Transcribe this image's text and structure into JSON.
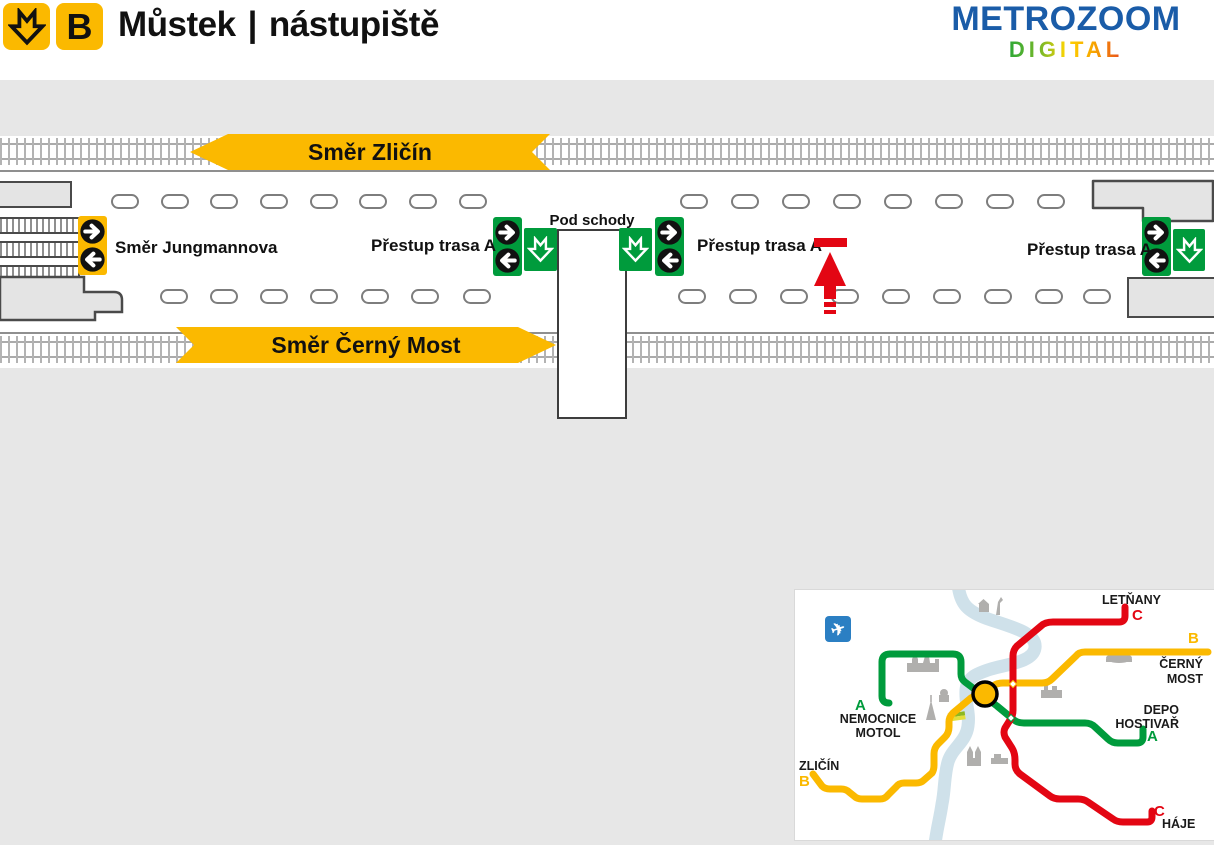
{
  "header": {
    "metro_line_letter": "B",
    "station_name": "Můstek",
    "separator": "|",
    "area_name": "nástupiště",
    "brand_name": "METROZOOM",
    "brand_sub": "DIGITAL",
    "brand_color": "#1A5CA8",
    "accent_yellow": "#FBB900"
  },
  "platform": {
    "direction_banner_top": "Směr Zličín",
    "direction_banner_bottom": "Směr Černý Most",
    "label_jungmannova": "Směr Jungmannova",
    "label_transfer_left": "Přestup trasa A",
    "label_under_stairs": "Pod schody",
    "label_transfer_middle": "Přestup trasa A",
    "label_transfer_right": "Přestup trasa A",
    "bench_rows": {
      "top_y": 194,
      "bottom_y": 289,
      "top_x": [
        111,
        161,
        210,
        260,
        310,
        359,
        409,
        459,
        680,
        731,
        782,
        833,
        884,
        935,
        986,
        1037
      ],
      "bottom_x": [
        160,
        210,
        260,
        310,
        361,
        411,
        463,
        678,
        729,
        780,
        831,
        882,
        933,
        984,
        1035,
        1083
      ]
    },
    "colors": {
      "sign_green": "#009B3C",
      "metro_yellow": "#FBB900",
      "marker_red": "#E30613",
      "background_gray": "#E7E7E7",
      "track_gray": "#AFAFAF"
    }
  },
  "minimap": {
    "current_station_color": "#FBB900",
    "river_color": "#CFE1EA",
    "airport_icon_color": "#2B7FC3",
    "airplane_glyph": "✈",
    "lines": {
      "A": "#009B3C",
      "B": "#FBB900",
      "C": "#E30613"
    },
    "labels": {
      "letnany": "LETŇANY",
      "letnany_line": "C",
      "cerny_most_line": "B",
      "cerny_most_1": "ČERNÝ",
      "cerny_most_2": "MOST",
      "depo_1": "DEPO",
      "depo_2": "HOSTIVAŘ",
      "depo_line": "A",
      "haje": "HÁJE",
      "haje_line": "C",
      "nemocnice_line": "A",
      "nemocnice_1": "NEMOCNICE",
      "nemocnice_2": "MOTOL",
      "zlicin": "ZLIČÍN",
      "zlicin_line": "B"
    }
  }
}
